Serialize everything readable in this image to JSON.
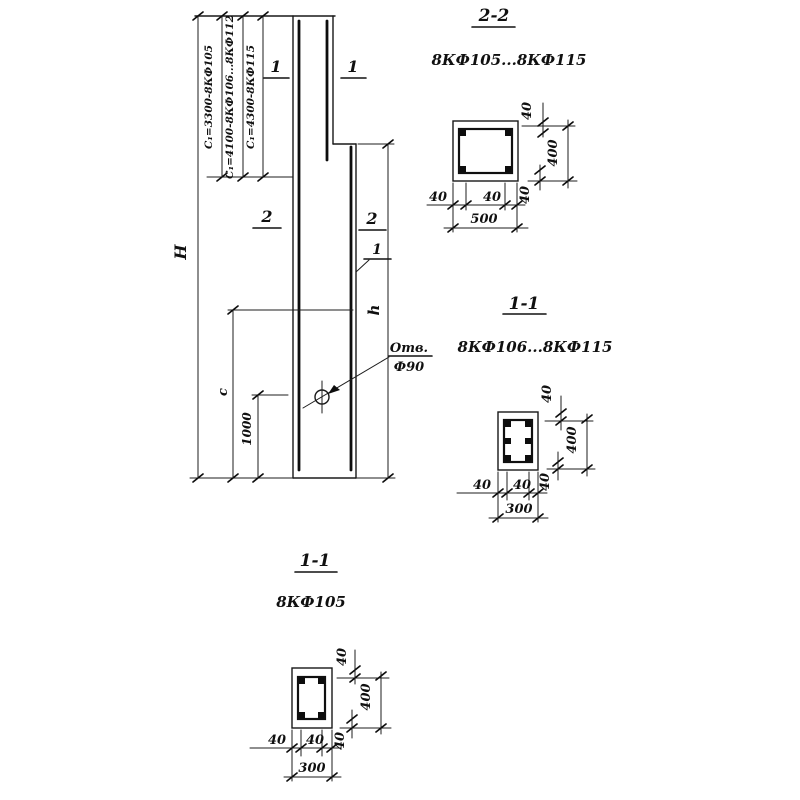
{
  "elevation": {
    "dim_overall_height": "Н",
    "dim_shaft_height": "h",
    "dim_c": "с",
    "dim_hole_offset": "1000",
    "c1_notes": [
      "С₁=3300-8КФ105",
      "С₁=4100-8КФ106...8КФ112",
      "С₁=4300-8КФ115"
    ],
    "hole_note_line1": "Отв.",
    "hole_note_line2": "Ф90",
    "cut_mark_1": "1",
    "cut_mark_2": "2",
    "rebar_item_mark": "1"
  },
  "section_2_2": {
    "title": "2-2",
    "products": "8КФ105...8КФ115",
    "cover_top": "40",
    "cover_bottom": "40",
    "cover_left": "40",
    "cover_right": "40",
    "depth": "400",
    "width": "500"
  },
  "section_1_1_mid": {
    "title": "1-1",
    "products": "8КФ106...8КФ115",
    "cover_top": "40",
    "cover_bottom": "40",
    "cover_left": "40",
    "cover_right": "40",
    "depth": "400",
    "width": "300"
  },
  "section_1_1_bottom": {
    "title": "1-1",
    "products": "8КФ105",
    "cover_top": "40",
    "cover_bottom": "40",
    "cover_left": "40",
    "cover_right": "40",
    "depth": "400",
    "width": "300"
  }
}
